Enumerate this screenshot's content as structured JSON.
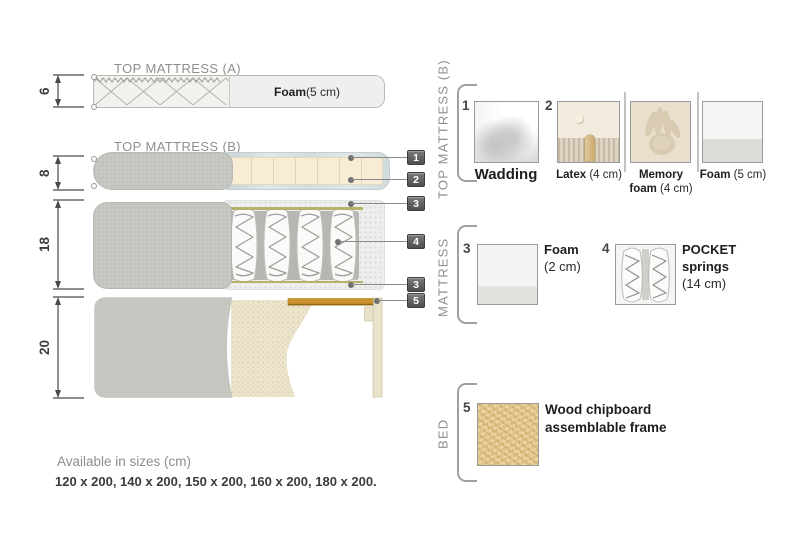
{
  "diagram": {
    "dims": {
      "top_a": "6",
      "top_b": "8",
      "mattress": "18",
      "bed": "20"
    },
    "top_mattress_a": {
      "title": "TOP MATTRESS (A)",
      "foam_bold": "Foam",
      "foam_rest": " (5 cm)"
    },
    "top_mattress_b": {
      "title": "TOP MATTRESS (B)"
    },
    "markers": [
      "1",
      "2",
      "3",
      "4",
      "3",
      "5"
    ]
  },
  "legend": {
    "sections": {
      "top_b": "TOP MATTRESS (B)",
      "mattress": "MATTRESS",
      "bed": "BED"
    },
    "wadding": {
      "num": "1",
      "name": "Wadding"
    },
    "latex": {
      "num": "2",
      "bold": "Latex",
      "rest": " (4 cm)"
    },
    "memory": {
      "bold1": "Memory",
      "bold2": "foam",
      "rest": " (4 cm)"
    },
    "foam5": {
      "bold": "Foam",
      "rest": " (5 cm)"
    },
    "foam2": {
      "num": "3",
      "bold": "Foam",
      "rest": "(2 cm)"
    },
    "pocket": {
      "num": "4",
      "bold1": "POCKET",
      "bold2": "springs",
      "rest": "(14 cm)"
    },
    "chipboard": {
      "num": "5",
      "line1": "Wood chipboard",
      "line2": "assemblable frame"
    }
  },
  "footer": {
    "availability": "Available in sizes (cm)",
    "sizes": "120 x 200, 140 x 200, 150 x 200, 160 x 200, 180 x 200."
  },
  "colors": {
    "marker": "#5a5a5a",
    "fabric": "#c7c8c2",
    "foam_cream": "#f7ebd4",
    "wadding_wrap": "#e0e7e7",
    "olive": "#b7b26a",
    "slat": "#c9932f",
    "chipboard": "#e3c98f",
    "label_gray": "#8f8f8f"
  }
}
